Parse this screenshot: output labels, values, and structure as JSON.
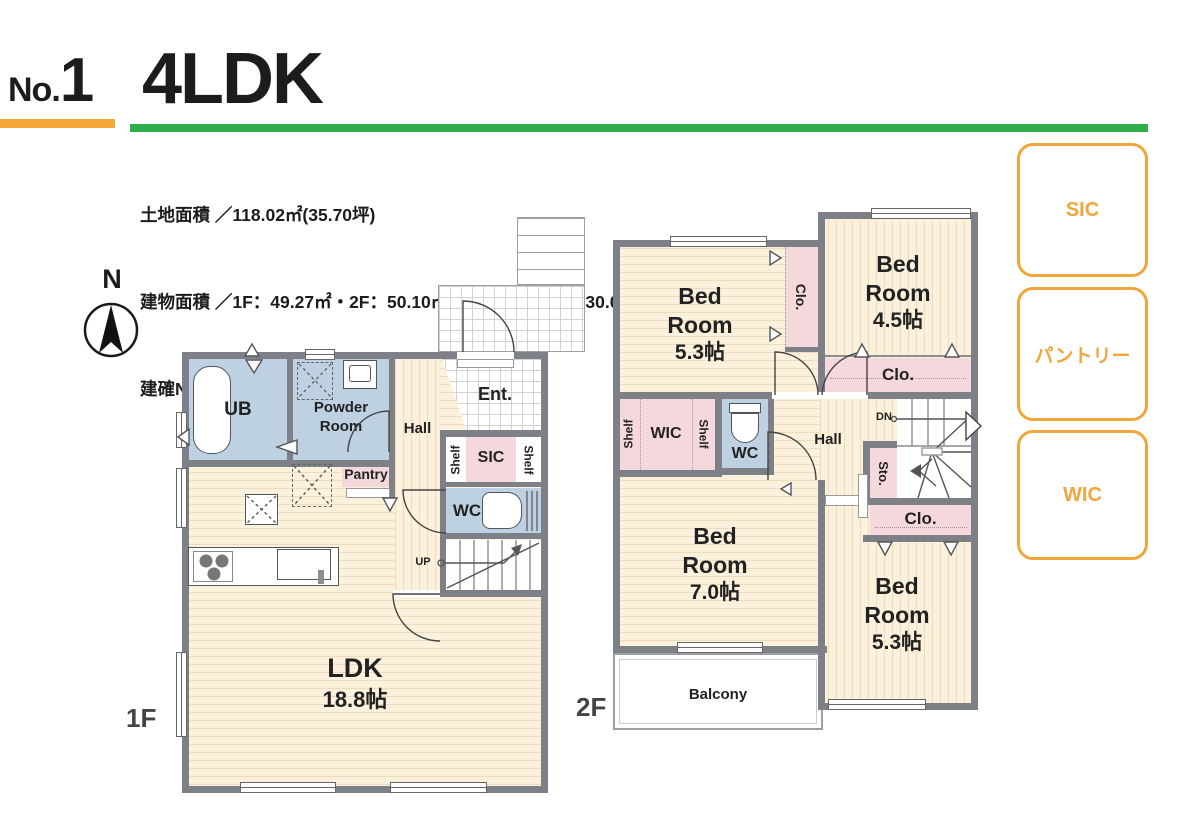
{
  "header": {
    "no_prefix": "No.",
    "no_number": "1",
    "title": "4LDK"
  },
  "info": {
    "land": "土地面積 ／118.02㎡(35.70坪)",
    "building": "建物面積 ／1F：49.27㎡・2F：50.10㎡　合計：99.37㎡(30.05坪)",
    "permit": "建確No.／第2025SBC-確01622H号"
  },
  "compass": {
    "north": "N"
  },
  "legend": {
    "items": [
      "SIC",
      "パントリー",
      "WIC"
    ]
  },
  "floor1": {
    "label": "1F",
    "ldk": {
      "name": "LDK",
      "size": "18.8帖"
    },
    "ub": "UB",
    "powder": "Powder Room",
    "hall": "Hall",
    "ent": "Ent.",
    "shelf_left": "Shelf",
    "shelf_right": "Shelf",
    "sic": "SIC",
    "wc": "WC",
    "pantry": "Pantry",
    "up": "UP"
  },
  "floor2": {
    "label": "2F",
    "hall": "Hall",
    "dn": "DN",
    "wc": "WC",
    "wic": "WIC",
    "shelf_left": "Shelf",
    "shelf_right": "Shelf",
    "sto": "Sto.",
    "clo_top": "Clo.",
    "clo_mid": "Clo.",
    "clo_bottom": "Clo.",
    "balcony": "Balcony",
    "bed1": {
      "name": "Bed Room",
      "size": "5.3帖"
    },
    "bed2": {
      "name": "Bed Room",
      "size": "4.5帖"
    },
    "bed3": {
      "name": "Bed Room",
      "size": "7.0帖"
    },
    "bed4": {
      "name": "Bed Room",
      "size": "5.3帖"
    }
  },
  "colors": {
    "accent_orange": "#f0a63c",
    "accent_green": "#2fad49",
    "wall_gray": "#7d8187",
    "floor_cream": "#fbf1dd",
    "wet_blue": "#bdd1e2",
    "storage_pink": "#f5d8dc"
  }
}
